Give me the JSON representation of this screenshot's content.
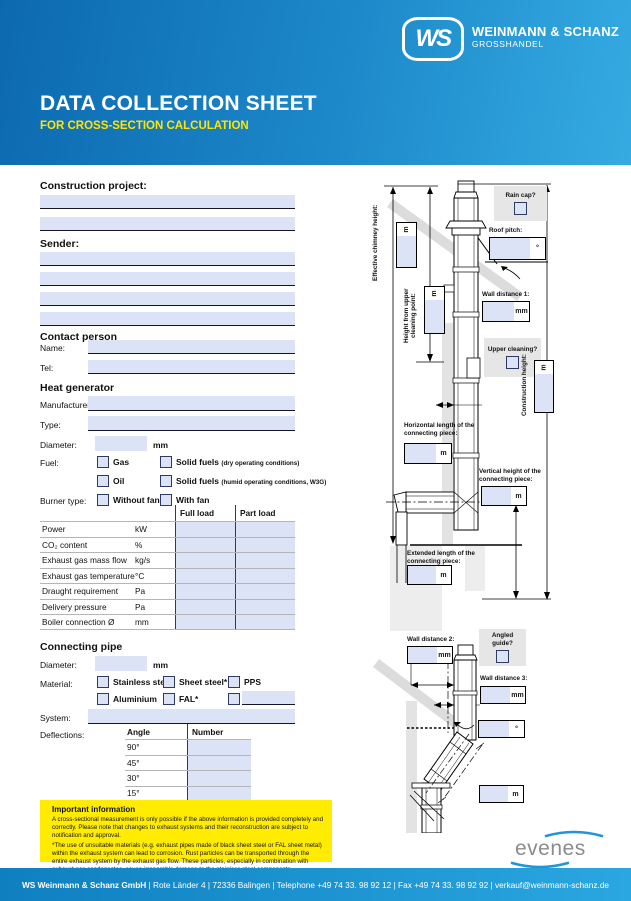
{
  "header": {
    "logo": "WS",
    "brand": "WEINMANN & SCHANZ",
    "brand_sub": "GROSSHANDEL",
    "title": "DATA COLLECTION SHEET",
    "subtitle": "FOR CROSS-SECTION CALCULATION"
  },
  "colors": {
    "accent_blue": "#1d89ca",
    "field_fill": "#dce3f7",
    "highlight_yellow": "#ffec00"
  },
  "sections": {
    "construction_project": "Construction project:",
    "sender": "Sender:",
    "contact_person": "Contact person",
    "heat_generator": "Heat generator",
    "connecting_pipe": "Connecting pipe"
  },
  "contact": {
    "name_label": "Name:",
    "tel_label": "Tel:"
  },
  "heat": {
    "manufacturer_label": "Manufacturer:",
    "type_label": "Type:",
    "diameter_label": "Diameter:",
    "diameter_unit": "mm",
    "fuel_label": "Fuel:",
    "fuel_gas": "Gas",
    "fuel_oil": "Oil",
    "fuel_solid_dry": "Solid fuels",
    "fuel_solid_dry_note": "(dry operating conditions)",
    "fuel_solid_humid": "Solid fuels",
    "fuel_solid_humid_note": "(humid operating conditions, W3G)",
    "burner_label": "Burner type:",
    "burner_without_fan": "Without fan",
    "burner_with_fan": "With fan"
  },
  "load_table": {
    "col_full": "Full load",
    "col_part": "Part load",
    "rows": [
      {
        "label": "Power",
        "unit": "kW"
      },
      {
        "label": "CO₂ content",
        "unit": "%"
      },
      {
        "label": "Exhaust gas mass flow",
        "unit": "kg/s"
      },
      {
        "label": "Exhaust gas temperature",
        "unit": "°C"
      },
      {
        "label": "Draught requirement",
        "unit": "Pa"
      },
      {
        "label": "Delivery pressure",
        "unit": "Pa"
      },
      {
        "label": "Boiler connection Ø",
        "unit": "mm"
      }
    ]
  },
  "pipe": {
    "diameter_label": "Diameter:",
    "diameter_unit": "mm",
    "material_label": "Material:",
    "materials_row1": [
      "Stainless steel",
      "Sheet steel*",
      "PPS"
    ],
    "materials_row2": [
      "Aluminium",
      "FAL*"
    ],
    "system_label": "System:",
    "deflections_label": "Deflections:",
    "deflection_cols": [
      "Angle",
      "Number"
    ],
    "deflection_angles": [
      "90°",
      "45°",
      "30°",
      "15°"
    ]
  },
  "important": {
    "title": "Important information",
    "p1": "A cross-sectional measurement is only possible if the above information is provided completely and correctly. Please note that changes to exhaust systems and their reconstruction are subject to notification and approval.",
    "p2": "*The use of unsuitable materials (e.g. exhaust pipes made of black sheet steel or FAL sheet metal) within the exhaust system can lead to corrosion. Rust particles can be transported through the entire exhaust system by the exhaust gas flow. These particles, especially in combination with exhaust gas condensates, cause irreparable damage to the stainless steel components."
  },
  "diagram1": {
    "effective_chimney_height": "Effective chimney height:",
    "height_upper_cleaning": "Height from upper cleaning point:",
    "rain_cap": "Rain cap?",
    "roof_pitch": "Roof pitch:",
    "wall_distance_1": "Wall distance 1:",
    "upper_cleaning": "Upper cleaning?",
    "construction_height": "Construction height:",
    "horizontal_length": "Horizontal length of the connecting piece:",
    "vertical_height": "Vertical height of the connecting piece:",
    "extended_length": "Extended length of the connecting piece:",
    "unit_m": "m",
    "unit_mm": "mm",
    "unit_deg": "°"
  },
  "diagram2": {
    "wall_distance_2": "Wall distance 2:",
    "angled_guide": "Angled guide?",
    "wall_distance_3": "Wall distance 3:",
    "unit_m": "m",
    "unit_mm": "mm",
    "unit_deg": "°"
  },
  "evenes_logo": "evenes",
  "footer": {
    "bold": "WS Weinmann & Schanz GmbH",
    "rest": " | Rote Länder 4 | 72336 Balingen | Telephone +49 74 33. 98 92 12 | Fax +49 74 33. 98 92 92 | verkauf@weinmann-schanz.de"
  }
}
